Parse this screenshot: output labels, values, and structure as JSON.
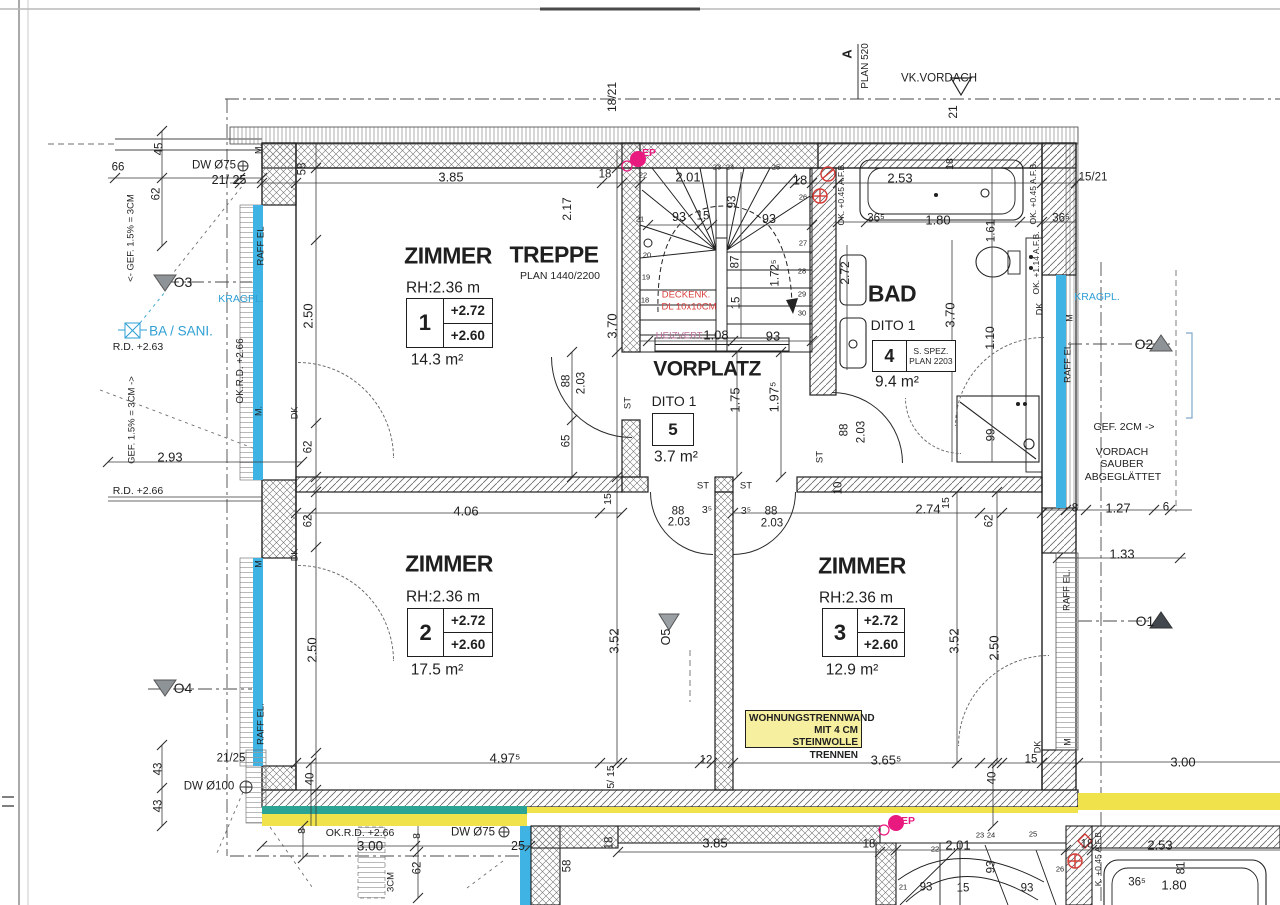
{
  "colors": {
    "blue": "#2e9fd4",
    "red": "#d84040",
    "pink": "#e8197f",
    "violet": "#b86e9a",
    "window_blue": "#3fb3e3",
    "teal": "#2ba395",
    "strip_yellow": "#efe24b",
    "note_yellow": "#f6efa0",
    "marker_gray": "#8e9397",
    "marker_dark": "#43484e"
  },
  "note": {
    "lines": [
      "WOHNUNGSTRENNWAND",
      "MIT 4 CM STEINWOLLE",
      "TRENNEN"
    ]
  },
  "rooms": [
    {
      "name": "ZIMMER",
      "rh": "RH:2.36 m",
      "number": "1",
      "levels": [
        "+2.72",
        "+2.60"
      ],
      "area": "14.3 m²",
      "type": "levels",
      "title_xy": [
        448,
        256
      ],
      "title_s": 23,
      "rh_xy": [
        443,
        288
      ],
      "box": [
        406,
        298,
        87,
        50
      ],
      "area_xy": [
        437,
        360
      ]
    },
    {
      "name": "TREPPE",
      "ref": "PLAN 1440/2200",
      "type": "title",
      "title_xy": [
        554,
        255
      ],
      "title_s": 23,
      "ref_xy": [
        560,
        276
      ]
    },
    {
      "name": "VORPLATZ",
      "dito": "DITO 1",
      "number": "5",
      "area": "3.7 m²",
      "type": "single",
      "title_xy": [
        707,
        369
      ],
      "title_s": 21,
      "dito_xy": [
        674,
        401
      ],
      "box": [
        652,
        413,
        42,
        33
      ],
      "area_xy": [
        676,
        457
      ]
    },
    {
      "name": "BAD",
      "dito": "DITO 1",
      "number": "4",
      "spez": [
        "S. SPEZ.",
        "PLAN 2203"
      ],
      "area": "9.4 m²",
      "type": "spez",
      "title_xy": [
        892,
        294
      ],
      "title_s": 23,
      "dito_xy": [
        893,
        325
      ],
      "box": [
        872,
        340,
        84,
        32
      ],
      "area_xy": [
        897,
        382
      ]
    },
    {
      "name": "ZIMMER",
      "rh": "RH:2.36 m",
      "number": "2",
      "levels": [
        "+2.72",
        "+2.60"
      ],
      "area": "17.5 m²",
      "type": "levels",
      "title_xy": [
        449,
        564
      ],
      "title_s": 23,
      "rh_xy": [
        443,
        597
      ],
      "box": [
        407,
        608,
        86,
        49
      ],
      "area_xy": [
        437,
        670
      ]
    },
    {
      "name": "ZIMMER",
      "rh": "RH:2.36 m",
      "number": "3",
      "levels": [
        "+2.72",
        "+2.60"
      ],
      "area": "12.9 m²",
      "type": "levels",
      "title_xy": [
        862,
        566
      ],
      "title_s": 23,
      "rh_xy": [
        856,
        598
      ],
      "box": [
        822,
        608,
        83,
        49
      ],
      "area_xy": [
        852,
        670
      ]
    }
  ],
  "labels": [
    {
      "t": "A",
      "x": 847,
      "y": 54,
      "r": -90,
      "s": 13,
      "b": 1
    },
    {
      "t": "PLAN 520",
      "x": 866,
      "y": 66,
      "r": -90,
      "s": 10
    },
    {
      "t": "VK.VORDACH",
      "x": 939,
      "y": 79,
      "s": 11.5
    },
    {
      "t": "18/21",
      "x": 612,
      "y": 97,
      "r": -90,
      "s": 12
    },
    {
      "t": "21",
      "x": 953,
      "y": 112,
      "r": -90,
      "s": 12
    },
    {
      "t": "15/21",
      "x": 1093,
      "y": 178,
      "s": 11.5
    },
    {
      "t": "66",
      "x": 118,
      "y": 168,
      "s": 11.5
    },
    {
      "t": "DW Ø75",
      "x": 214,
      "y": 166,
      "s": 11.5
    },
    {
      "t": "21/ 25",
      "x": 229,
      "y": 180,
      "s": 12.5
    },
    {
      "t": "45",
      "x": 160,
      "y": 149,
      "r": -90,
      "s": 11.5
    },
    {
      "t": "62",
      "x": 157,
      "y": 194,
      "r": -90,
      "s": 11.5
    },
    {
      "t": "M.",
      "x": 259,
      "y": 149,
      "r": -90,
      "s": 9
    },
    {
      "t": "<- GEF. 1.5% = 3CM",
      "x": 131,
      "y": 238,
      "r": -90,
      "s": 9.5
    },
    {
      "t": "RAFF EL",
      "x": 261,
      "y": 246,
      "r": -90,
      "s": 9.5
    },
    {
      "t": "O3",
      "x": 183,
      "y": 282,
      "s": 14
    },
    {
      "t": "KRAGPL.",
      "x": 241,
      "y": 299,
      "s": 10.5,
      "c": "blue"
    },
    {
      "t": "BA / SANI.",
      "x": 181,
      "y": 331,
      "s": 13.5,
      "c": "blue"
    },
    {
      "t": "R.D. +2.63",
      "x": 138,
      "y": 347,
      "s": 10.5
    },
    {
      "t": "OK.R.D. +2.66",
      "x": 241,
      "y": 371,
      "r": -90,
      "s": 10
    },
    {
      "t": "M.",
      "x": 259,
      "y": 411,
      "r": -90,
      "s": 9
    },
    {
      "t": "GEF. 1.5% = 3CM ->",
      "x": 132,
      "y": 420,
      "r": -90,
      "s": 9.5
    },
    {
      "t": "2.93",
      "x": 170,
      "y": 457,
      "s": 13
    },
    {
      "t": "R.D. +2.66",
      "x": 138,
      "y": 491,
      "s": 10.5
    },
    {
      "t": "M",
      "x": 259,
      "y": 564,
      "r": -90,
      "s": 9
    },
    {
      "t": "RAFF EL.",
      "x": 261,
      "y": 724,
      "r": -90,
      "s": 9.5
    },
    {
      "t": "O4",
      "x": 183,
      "y": 688,
      "s": 14
    },
    {
      "t": "21/25",
      "x": 231,
      "y": 759,
      "s": 11.5
    },
    {
      "t": "DW Ø100",
      "x": 209,
      "y": 787,
      "s": 11.5
    },
    {
      "t": "43",
      "x": 159,
      "y": 769,
      "r": -90,
      "s": 11.5
    },
    {
      "t": "43",
      "x": 159,
      "y": 806,
      "r": -90,
      "s": 11.5
    },
    {
      "t": "58",
      "x": 303,
      "y": 169,
      "r": -90,
      "s": 11.5
    },
    {
      "t": "3.85",
      "x": 451,
      "y": 177,
      "s": 13
    },
    {
      "t": "18",
      "x": 605,
      "y": 175,
      "s": 11.5
    },
    {
      "t": "2.01",
      "x": 688,
      "y": 177,
      "s": 13
    },
    {
      "t": "18",
      "x": 800,
      "y": 180,
      "s": 13
    },
    {
      "t": "2.53",
      "x": 900,
      "y": 178,
      "s": 13
    },
    {
      "t": "18",
      "x": 950,
      "y": 164,
      "r": -90,
      "s": 10.5
    },
    {
      "t": "36⁵",
      "x": 876,
      "y": 219,
      "s": 11.5
    },
    {
      "t": "1.80",
      "x": 938,
      "y": 220,
      "s": 13
    },
    {
      "t": "36⁵",
      "x": 1061,
      "y": 219,
      "s": 11.5
    },
    {
      "t": "1.61",
      "x": 992,
      "y": 231,
      "r": -90,
      "s": 11.5
    },
    {
      "t": "OK. +0.45 A.F.B.",
      "x": 841,
      "y": 194,
      "r": -90,
      "s": 8.5
    },
    {
      "t": "OK. +0.45 A.F.B.",
      "x": 1033,
      "y": 193,
      "r": -90,
      "s": 8.5
    },
    {
      "t": "OK. +1.14 A.F.B.",
      "x": 1036,
      "y": 263,
      "r": -90,
      "s": 8.5
    },
    {
      "t": "DK",
      "x": 1040,
      "y": 309,
      "r": -90,
      "s": 9
    },
    {
      "t": "2.17",
      "x": 567,
      "y": 209,
      "r": -90,
      "s": 12
    },
    {
      "t": "2.50",
      "x": 308,
      "y": 316,
      "r": -90,
      "s": 13
    },
    {
      "t": "3.70",
      "x": 612,
      "y": 326,
      "r": -90,
      "s": 13
    },
    {
      "t": "88",
      "x": 567,
      "y": 381,
      "r": -90,
      "s": 11.5
    },
    {
      "t": "2.03",
      "x": 582,
      "y": 383,
      "r": -90,
      "s": 11.5
    },
    {
      "t": "ST",
      "x": 628,
      "y": 403,
      "r": -90,
      "s": 9.5
    },
    {
      "t": "65",
      "x": 567,
      "y": 441,
      "r": -90,
      "s": 11.5
    },
    {
      "t": "DK",
      "x": 295,
      "y": 413,
      "r": -90,
      "s": 9
    },
    {
      "t": "62",
      "x": 309,
      "y": 447,
      "r": -90,
      "s": 11.5
    },
    {
      "t": "62",
      "x": 309,
      "y": 521,
      "r": -90,
      "s": 11.5
    },
    {
      "t": "DK",
      "x": 295,
      "y": 555,
      "r": -90,
      "s": 9
    },
    {
      "t": "4.06",
      "x": 466,
      "y": 511,
      "s": 13
    },
    {
      "t": "15",
      "x": 608,
      "y": 499,
      "r": -90,
      "s": 10.5
    },
    {
      "t": "22",
      "x": 643,
      "y": 175,
      "s": 7.5
    },
    {
      "t": "21",
      "x": 640,
      "y": 219,
      "s": 7.5
    },
    {
      "t": "20",
      "x": 647,
      "y": 255,
      "s": 7.5
    },
    {
      "t": "19",
      "x": 646,
      "y": 277,
      "s": 7.5
    },
    {
      "t": "18",
      "x": 645,
      "y": 300,
      "s": 7.5
    },
    {
      "t": "23",
      "x": 717,
      "y": 167,
      "s": 7.5
    },
    {
      "t": "24",
      "x": 730,
      "y": 167,
      "s": 7.5
    },
    {
      "t": "25",
      "x": 776,
      "y": 167,
      "s": 7.5
    },
    {
      "t": "26",
      "x": 803,
      "y": 197,
      "s": 7.5
    },
    {
      "t": "27",
      "x": 803,
      "y": 243,
      "s": 7.5
    },
    {
      "t": "28",
      "x": 802,
      "y": 271,
      "s": 7.5
    },
    {
      "t": "29",
      "x": 802,
      "y": 294,
      "s": 7.5
    },
    {
      "t": "30",
      "x": 802,
      "y": 313,
      "s": 7.5
    },
    {
      "t": "93",
      "x": 679,
      "y": 217,
      "s": 12.5
    },
    {
      "t": "15",
      "x": 703,
      "y": 217,
      "s": 11.5
    },
    {
      "t": "93",
      "x": 733,
      "y": 202,
      "r": -90,
      "s": 11.5
    },
    {
      "t": "93",
      "x": 769,
      "y": 219,
      "s": 12.5
    },
    {
      "t": "87",
      "x": 736,
      "y": 262,
      "r": -90,
      "s": 11.5
    },
    {
      "t": "15",
      "x": 737,
      "y": 303,
      "r": -90,
      "s": 11.5
    },
    {
      "t": "1.72⁵",
      "x": 776,
      "y": 273,
      "r": -90,
      "s": 11.5
    },
    {
      "t": "DECKENK.",
      "x": 686,
      "y": 295,
      "s": 9.5,
      "c": "red"
    },
    {
      "t": "DL 10x10CM",
      "x": 689,
      "y": 307,
      "s": 9.5,
      "c": "red"
    },
    {
      "t": "HEIZVERT.",
      "x": 680,
      "y": 336,
      "s": 9.5,
      "c": "violet"
    },
    {
      "t": "1.08",
      "x": 716,
      "y": 335,
      "s": 13
    },
    {
      "t": "93",
      "x": 773,
      "y": 336,
      "s": 13
    },
    {
      "t": "EP",
      "x": 649,
      "y": 153,
      "s": 10.5,
      "c": "pink",
      "b": 1
    },
    {
      "t": "EP",
      "x": 908,
      "y": 821,
      "s": 10.5,
      "c": "pink",
      "b": 1
    },
    {
      "t": "1.75",
      "x": 735,
      "y": 400,
      "r": -90,
      "s": 13
    },
    {
      "t": "1.97⁵",
      "x": 774,
      "y": 397,
      "r": -90,
      "s": 13
    },
    {
      "t": "88",
      "x": 845,
      "y": 430,
      "r": -90,
      "s": 11.5
    },
    {
      "t": "2.03",
      "x": 862,
      "y": 432,
      "r": -90,
      "s": 11.5
    },
    {
      "t": "ST",
      "x": 820,
      "y": 457,
      "r": -90,
      "s": 9.5
    },
    {
      "t": "10",
      "x": 839,
      "y": 488,
      "r": -90,
      "s": 11.5
    },
    {
      "t": "ST",
      "x": 703,
      "y": 486,
      "s": 9.5
    },
    {
      "t": "ST",
      "x": 746,
      "y": 486,
      "s": 9.5
    },
    {
      "t": "88",
      "x": 678,
      "y": 512,
      "s": 11.5
    },
    {
      "t": "3⁵",
      "x": 707,
      "y": 510,
      "s": 10.5
    },
    {
      "t": "3⁵",
      "x": 746,
      "y": 511,
      "s": 10.5
    },
    {
      "t": "88",
      "x": 771,
      "y": 512,
      "s": 11.5
    },
    {
      "t": "2.03",
      "x": 679,
      "y": 523,
      "s": 11.5
    },
    {
      "t": "2.03",
      "x": 772,
      "y": 524,
      "s": 11.5
    },
    {
      "t": "2.72",
      "x": 845,
      "y": 273,
      "r": -90,
      "s": 12
    },
    {
      "t": "3.70",
      "x": 950,
      "y": 315,
      "r": -90,
      "s": 13
    },
    {
      "t": "1.10",
      "x": 990,
      "y": 338,
      "r": -90,
      "s": 12
    },
    {
      "t": "99",
      "x": 992,
      "y": 435,
      "r": -90,
      "s": 11.5
    },
    {
      "t": "2.74",
      "x": 928,
      "y": 509,
      "s": 13
    },
    {
      "t": "15",
      "x": 946,
      "y": 503,
      "r": -90,
      "s": 10.5
    },
    {
      "t": "62",
      "x": 990,
      "y": 521,
      "r": -90,
      "s": 11.5
    },
    {
      "t": "8",
      "x": 1075,
      "y": 509,
      "s": 11.5
    },
    {
      "t": "1.27",
      "x": 1118,
      "y": 508,
      "s": 13
    },
    {
      "t": "6",
      "x": 1166,
      "y": 508,
      "s": 11.5
    },
    {
      "t": "KRAGPL.",
      "x": 1097,
      "y": 297,
      "s": 10.5,
      "c": "blue"
    },
    {
      "t": "M",
      "x": 1070,
      "y": 318,
      "r": -90,
      "s": 9
    },
    {
      "t": "RAFF EL.",
      "x": 1068,
      "y": 362,
      "r": -90,
      "s": 9.5
    },
    {
      "t": "O2",
      "x": 1144,
      "y": 344,
      "s": 14
    },
    {
      "t": "GEF. 2CM ->",
      "x": 1124,
      "y": 427,
      "s": 10.5
    },
    {
      "t": "VORDACH",
      "x": 1122,
      "y": 452,
      "s": 10.5
    },
    {
      "t": "SAUBER",
      "x": 1122,
      "y": 464,
      "s": 10.5
    },
    {
      "t": "ABGEGLÄTTET",
      "x": 1123,
      "y": 477,
      "s": 10.5
    },
    {
      "t": "1.33",
      "x": 1122,
      "y": 554,
      "s": 13
    },
    {
      "t": "RAFF EL.",
      "x": 1067,
      "y": 590,
      "r": -90,
      "s": 9.5
    },
    {
      "t": "O1",
      "x": 1145,
      "y": 621,
      "s": 14
    },
    {
      "t": "M",
      "x": 1068,
      "y": 742,
      "r": -90,
      "s": 9
    },
    {
      "t": "DK",
      "x": 1038,
      "y": 747,
      "r": -90,
      "s": 9
    },
    {
      "t": "O5",
      "x": 666,
      "y": 637,
      "r": -90,
      "s": 12.5
    },
    {
      "t": "2.50",
      "x": 312,
      "y": 650,
      "r": -90,
      "s": 13
    },
    {
      "t": "3.52",
      "x": 614,
      "y": 641,
      "r": -90,
      "s": 13
    },
    {
      "t": "3.52",
      "x": 954,
      "y": 641,
      "r": -90,
      "s": 13
    },
    {
      "t": "2.50",
      "x": 994,
      "y": 648,
      "r": -90,
      "s": 13
    },
    {
      "t": "40",
      "x": 311,
      "y": 779,
      "r": -90,
      "s": 11.5
    },
    {
      "t": "4.97⁵",
      "x": 505,
      "y": 758,
      "s": 13
    },
    {
      "t": "5/ 15",
      "x": 611,
      "y": 777,
      "r": -90,
      "s": 10.5
    },
    {
      "t": "12",
      "x": 706,
      "y": 761,
      "s": 11.5
    },
    {
      "t": "3.65⁵",
      "x": 886,
      "y": 760,
      "s": 13
    },
    {
      "t": "40",
      "x": 993,
      "y": 778,
      "r": -90,
      "s": 11.5
    },
    {
      "t": "15",
      "x": 1031,
      "y": 760,
      "s": 11.5
    },
    {
      "t": "3.00",
      "x": 1183,
      "y": 762,
      "s": 13
    },
    {
      "t": "8",
      "x": 302,
      "y": 831,
      "r": -90,
      "s": 10.5
    },
    {
      "t": "OK.R.D. +2.66",
      "x": 360,
      "y": 833,
      "s": 10.5
    },
    {
      "t": "3.00",
      "x": 370,
      "y": 846,
      "s": 13.5
    },
    {
      "t": "8",
      "x": 417,
      "y": 836,
      "r": -90,
      "s": 10.5
    },
    {
      "t": "DW Ø75",
      "x": 473,
      "y": 833,
      "s": 11.5
    },
    {
      "t": "25",
      "x": 518,
      "y": 846,
      "s": 12.5
    },
    {
      "t": "62",
      "x": 418,
      "y": 868,
      "r": -90,
      "s": 11.5
    },
    {
      "t": "3CM",
      "x": 391,
      "y": 882,
      "r": -90,
      "s": 9.5
    },
    {
      "t": "58",
      "x": 568,
      "y": 866,
      "r": -90,
      "s": 11.5
    },
    {
      "t": "18",
      "x": 610,
      "y": 843,
      "r": -90,
      "s": 11.5
    },
    {
      "t": "3.85",
      "x": 715,
      "y": 843,
      "s": 13
    },
    {
      "t": "18",
      "x": 869,
      "y": 845,
      "s": 11.5
    },
    {
      "t": "22",
      "x": 935,
      "y": 849,
      "s": 7.5
    },
    {
      "t": "2.01",
      "x": 958,
      "y": 845,
      "s": 13
    },
    {
      "t": "23",
      "x": 980,
      "y": 835,
      "s": 7.5
    },
    {
      "t": "24",
      "x": 991,
      "y": 835,
      "s": 7.5
    },
    {
      "t": "25",
      "x": 1033,
      "y": 834,
      "s": 7.5
    },
    {
      "t": "26",
      "x": 1060,
      "y": 869,
      "s": 7.5
    },
    {
      "t": "93",
      "x": 992,
      "y": 867,
      "r": -90,
      "s": 11.5
    },
    {
      "t": "18",
      "x": 1087,
      "y": 845,
      "s": 11.5
    },
    {
      "t": "K. +0.45 A.F.B.",
      "x": 1098,
      "y": 858,
      "r": -90,
      "s": 8.5
    },
    {
      "t": "2.53",
      "x": 1160,
      "y": 845,
      "s": 13
    },
    {
      "t": "81",
      "x": 1182,
      "y": 868,
      "r": -90,
      "s": 11.5
    },
    {
      "t": "36⁵",
      "x": 1137,
      "y": 883,
      "s": 11.5
    },
    {
      "t": "1.80",
      "x": 1174,
      "y": 885,
      "s": 13
    },
    {
      "t": "21",
      "x": 903,
      "y": 887,
      "s": 7.5
    },
    {
      "t": "93",
      "x": 926,
      "y": 888,
      "s": 11.5
    },
    {
      "t": "15",
      "x": 963,
      "y": 889,
      "s": 11.5
    },
    {
      "t": "93",
      "x": 1027,
      "y": 889,
      "s": 11.5
    }
  ]
}
